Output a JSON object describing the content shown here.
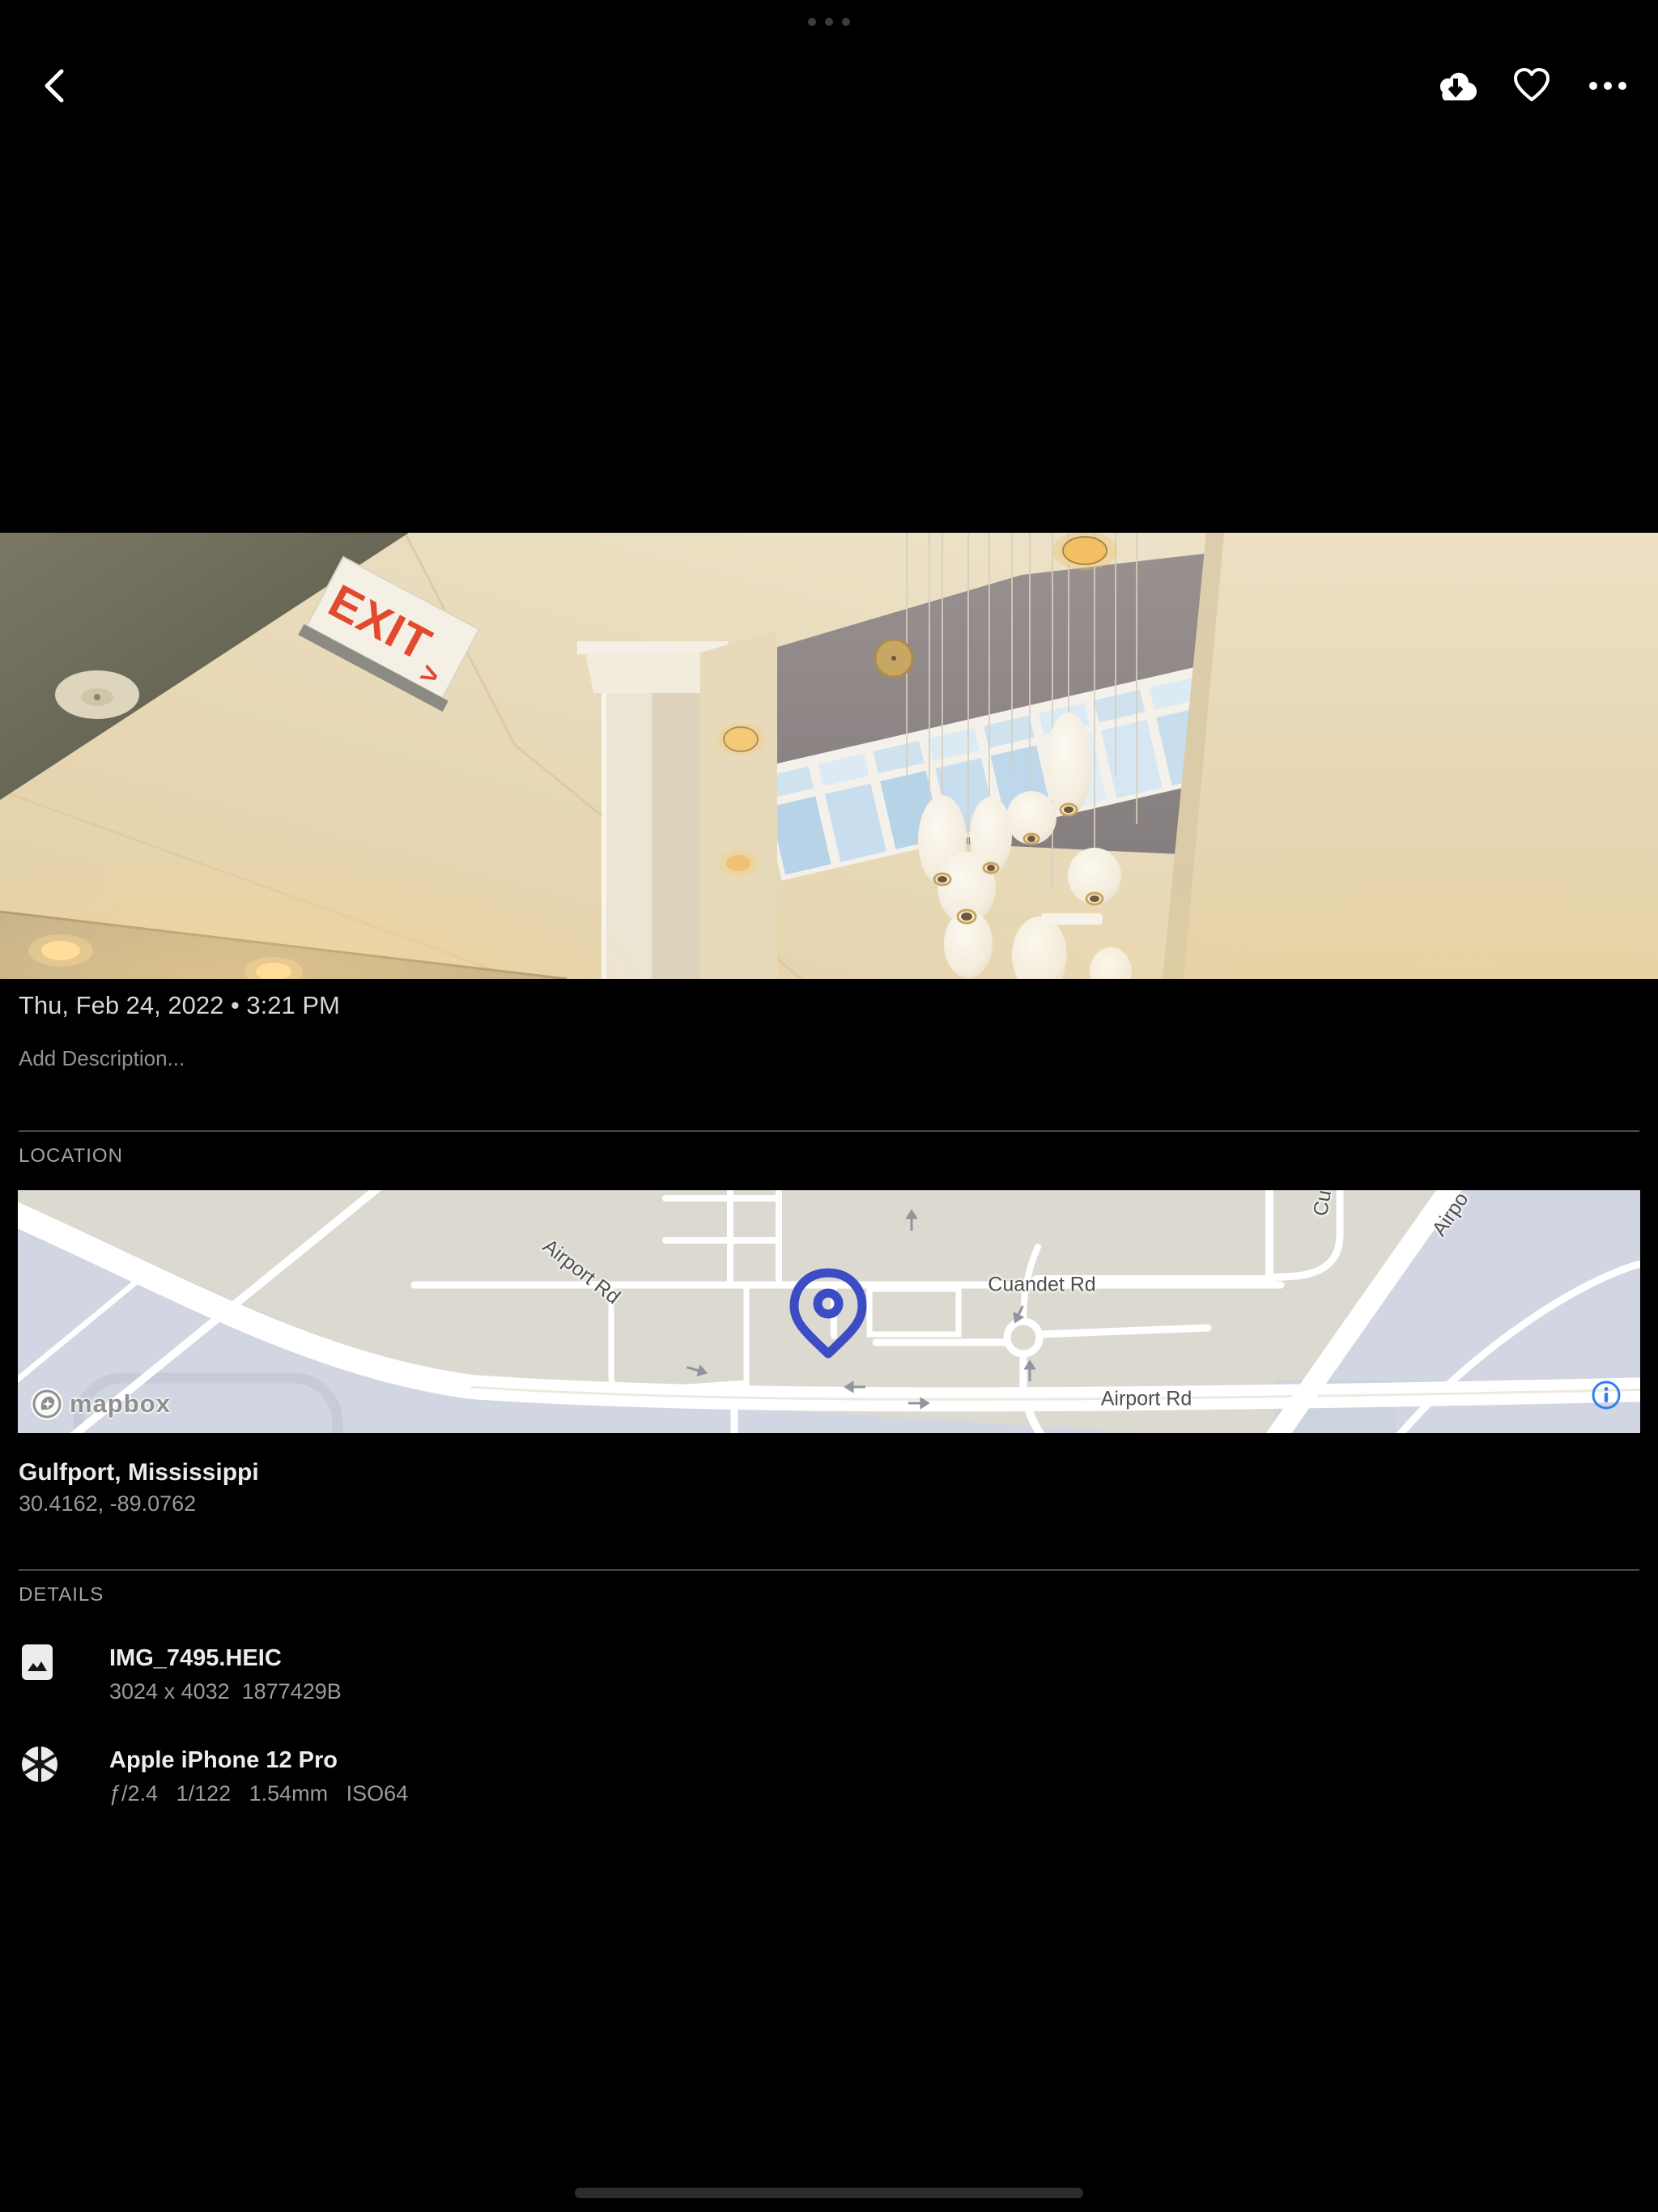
{
  "toolbar": {
    "back_icon": "chevron-left",
    "download_icon": "cloud-download",
    "favorite_icon": "heart-outline",
    "more_icon": "three-dots"
  },
  "photo": {
    "exit_sign": "EXIT",
    "exit_sign_arrow": ">"
  },
  "info": {
    "date": "Thu, Feb 24, 2022 • 3:21 PM",
    "description_placeholder": "Add Description..."
  },
  "location": {
    "label": "LOCATION",
    "place": "Gulfport, Mississippi",
    "coordinates": "30.4162, -89.0762",
    "map": {
      "attribution": "mapbox",
      "pin_color": "#3b4cc4",
      "info_icon_color": "#2e7ff0",
      "labels": {
        "airport_rd_diagonal": "Airport Rd",
        "cuandet_rd": "Cuandet Rd",
        "airport_rd_bottom": "Airport Rd",
        "airport_rd_partial": "Airpo",
        "cut_road_partial": "Cu"
      }
    }
  },
  "details": {
    "label": "DETAILS",
    "rows": [
      {
        "icon": "image-icon",
        "title": "IMG_7495.HEIC",
        "subtitle": "3024 x 4032  1877429B"
      },
      {
        "icon": "aperture-icon",
        "title": "Apple iPhone 12 Pro",
        "subtitle": "ƒ/2.4   1/122   1.54mm   ISO64"
      }
    ]
  }
}
